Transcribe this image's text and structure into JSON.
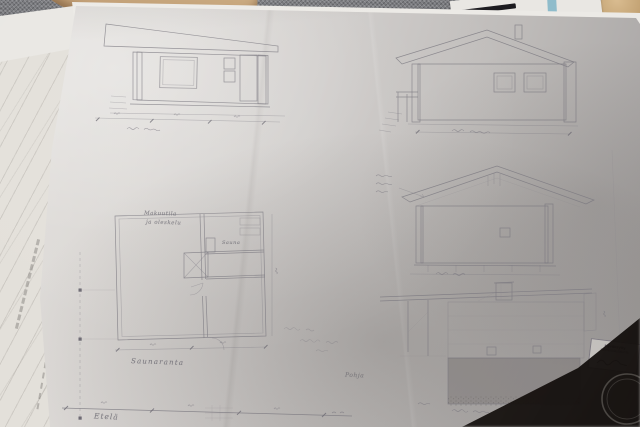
{
  "annotations": {
    "plan_room_line1": "Makuutila",
    "plan_room_line2": "ja oleskelu",
    "plan_sauna": "Sauna",
    "plan_caption": "Saunaranta",
    "lower_caption": "Pohja",
    "bottom_left_caption": "Etelä"
  },
  "stamp": {
    "line1": "Hyväksytty",
    "line2": "rakennuslautakunta"
  },
  "colors": {
    "paper": "#d6d4d1",
    "paper_shadow": "#a5a2a1",
    "graphite": "#7b7880",
    "fabric": "#75767a",
    "wood_armrest": "#c6a87e",
    "teal_stripe": "#8fbccb",
    "desk_dark": "#2b2522",
    "stamp_ink": "#4a4455"
  }
}
